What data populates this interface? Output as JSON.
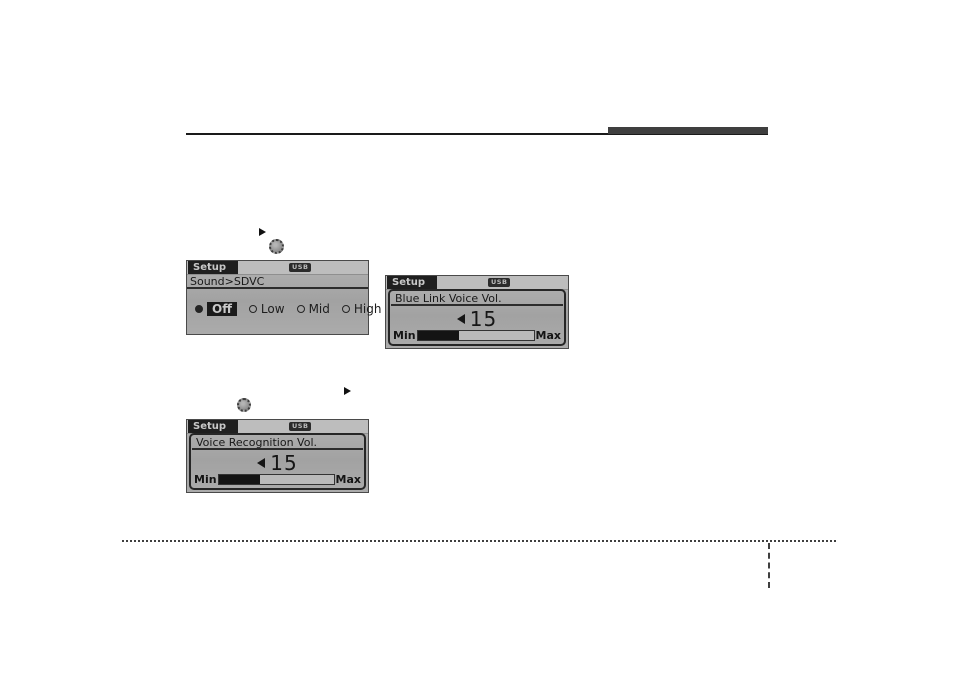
{
  "colors": {
    "accent_bar": "#3f3f3f",
    "screen_body": "#a9a9a9",
    "tab_bg": "#1f1f1f",
    "highlight_bg": "#1b1b1b",
    "slider_fill": "#141414"
  },
  "screens": {
    "sdvc": {
      "tab_label": "Setup",
      "usb_badge": "USB",
      "breadcrumb": "Sound>SDVC",
      "options": [
        {
          "label": "Off",
          "selected": true
        },
        {
          "label": "Low",
          "selected": false
        },
        {
          "label": "Mid",
          "selected": false
        },
        {
          "label": "High",
          "selected": false
        }
      ]
    },
    "bluelink": {
      "tab_label": "Setup",
      "usb_badge": "USB",
      "title": "Blue Link Voice Vol.",
      "value": "15",
      "min_label": "Min",
      "max_label": "Max",
      "fill_percent": 36
    },
    "voicerec": {
      "tab_label": "Setup",
      "usb_badge": "USB",
      "title": "Voice Recognition Vol.",
      "value": "15",
      "min_label": "Min",
      "max_label": "Max",
      "fill_percent": 36
    }
  }
}
